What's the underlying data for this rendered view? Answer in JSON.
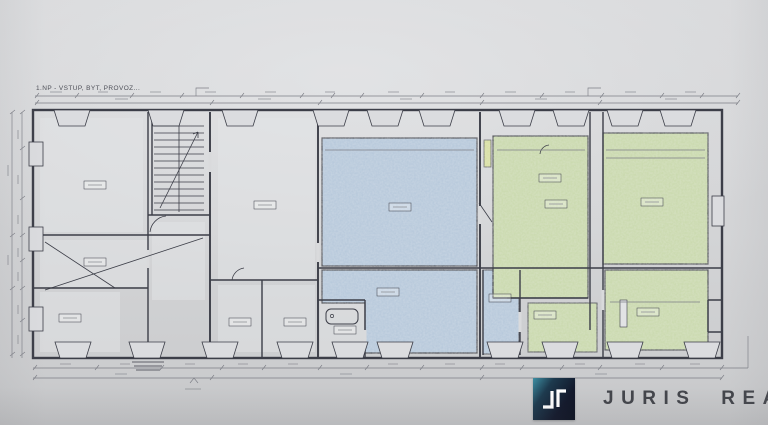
{
  "css_vars": {
    "--ink": "#3b3d47",
    "--blue": "#b5c8db",
    "--green": "#c9d9ab",
    "--yellow": "#d8df9f",
    "--logo-from": "#3e8fa3",
    "--logo-to": "#12182b",
    "--brandtext": "#43454b"
  },
  "plan": {
    "title": "1.NP - VSTUP, BYT, PROVOZ...",
    "highlighted_zones": {
      "blue_zone": "large central hall and rear room",
      "green_zone": "two right-side units with small rear rooms",
      "corridor": "narrow blue corridor between green units"
    }
  },
  "branding": {
    "logo_text": "JURIS REAL",
    "logo_monogram": "Jr"
  }
}
